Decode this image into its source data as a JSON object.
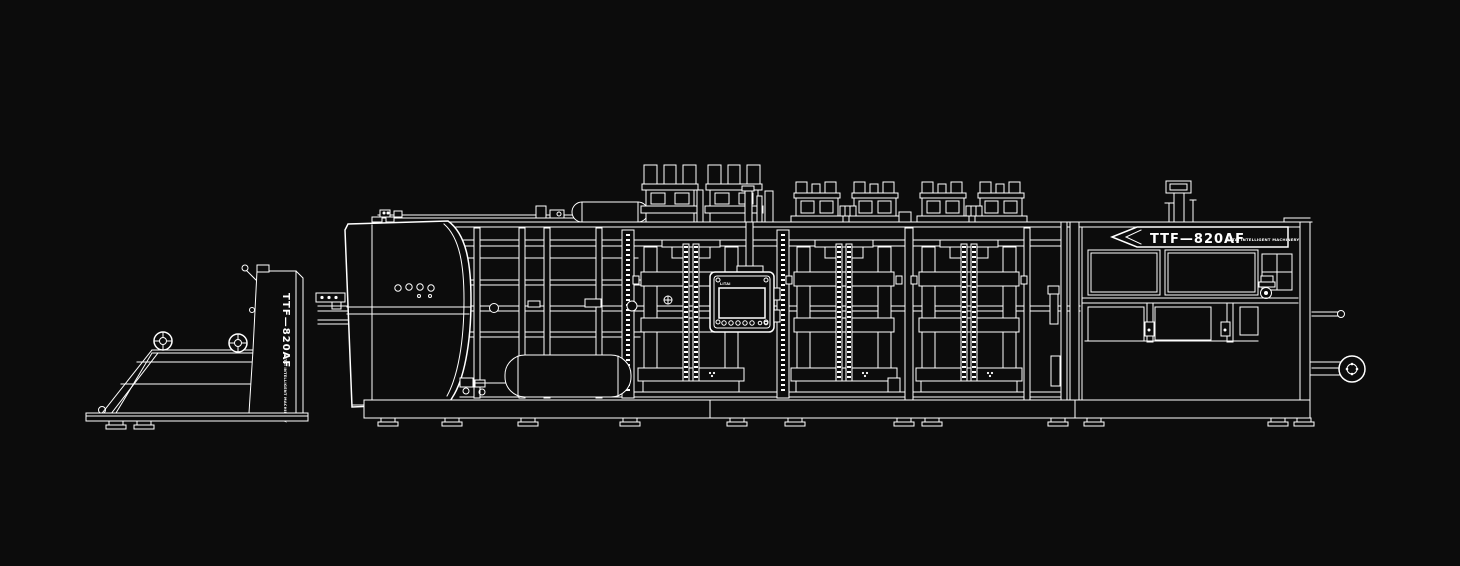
{
  "illustration": {
    "background_color": "#0c0c0c",
    "line_color": "#ffffff"
  },
  "labels": {
    "nameplate_model": "TTF—820AF",
    "nameplate_brand": "LITAI INTELLIGENT MACHINERY",
    "feeder_model": "TTF—820AF",
    "feeder_brand": "LITAI INTELLIGENT MACHINERY",
    "hmi_label": "LITAI"
  }
}
